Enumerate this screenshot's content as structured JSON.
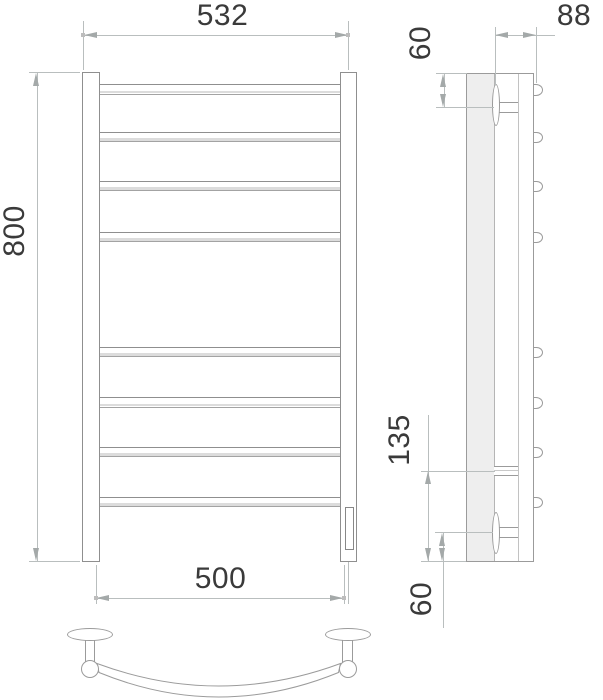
{
  "title": "Ladder towel rail dimensional drawing",
  "dimensions": {
    "front": {
      "overall_width": "532",
      "overall_height": "800",
      "mount_center_width": "500"
    },
    "side": {
      "depth": "88",
      "top_bracket_offset": "60",
      "element_height": "135",
      "bottom_bracket_offset": "60"
    }
  },
  "structure": {
    "rung_count": 8,
    "views": [
      "front-view",
      "side-view",
      "top-view-of-rung"
    ]
  },
  "colors": {
    "outline": "#9b9b9b",
    "dimension_line": "#b9bebe",
    "label_text": "#3a3a3a",
    "wall_fill": "#eeeeee",
    "highlight_line": "#dcdcdc"
  }
}
